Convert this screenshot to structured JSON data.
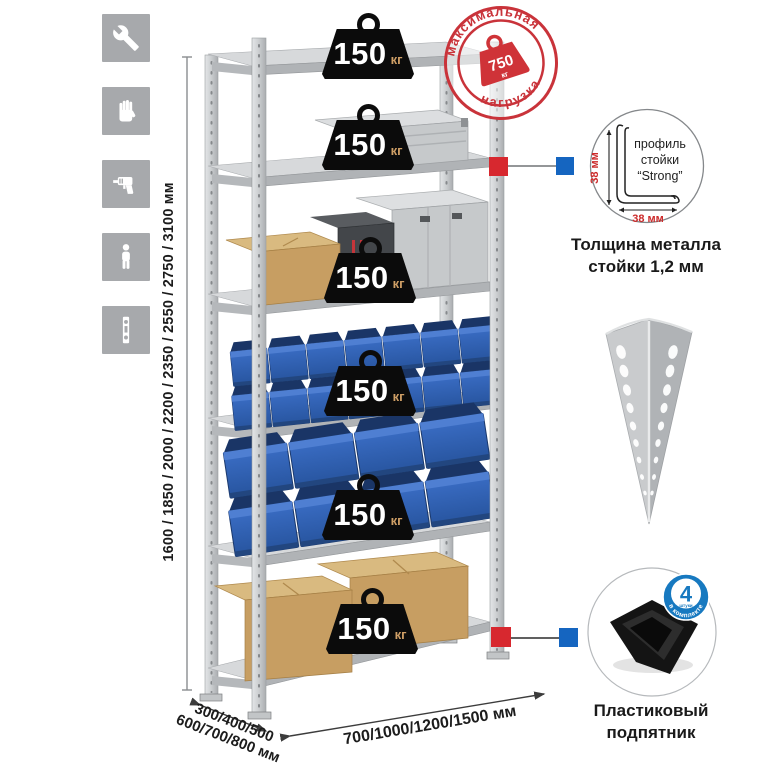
{
  "dimensions": {
    "height_options": "1600 / 1850 / 2000 / 2200 / 2350 / 2550 / 2750 / 3100 мм",
    "depth_options_line1": "300/400/500",
    "depth_options_line2": "600/700/800 мм",
    "width_options": "700/1000/1200/1500 мм"
  },
  "shelf_load": {
    "value": "150",
    "unit": "кг"
  },
  "max_load": {
    "arc_top": "максимальная",
    "arc_bottom": "нагрузка",
    "value": "750",
    "unit": "кг"
  },
  "post_profile": {
    "line1": "профиль",
    "line2": "стойки",
    "line3": "“Strong”",
    "dim_vertical": "38 мм",
    "dim_horizontal": "38 мм",
    "caption_line1": "Толщина металла",
    "caption_line2": "стойки 1,2 мм"
  },
  "foot": {
    "badge_value": "4",
    "badge_unit": "штуки",
    "badge_arc": "в комплекте",
    "caption_line1": "Пластиковый",
    "caption_line2": "подпятник"
  },
  "side_icons": [
    {
      "name": "wrench-icon"
    },
    {
      "name": "gloves-icon"
    },
    {
      "name": "drill-icon"
    },
    {
      "name": "person-icon"
    },
    {
      "name": "post-profile-icon"
    }
  ],
  "colors": {
    "accent_red": "#d7282f",
    "accent_blue": "#1565c0",
    "stamp_red": "#cc3338",
    "badge_blue": "#1779c0",
    "bin_blue": "#2e5dac",
    "icon_gray": "#a7a9ac"
  }
}
